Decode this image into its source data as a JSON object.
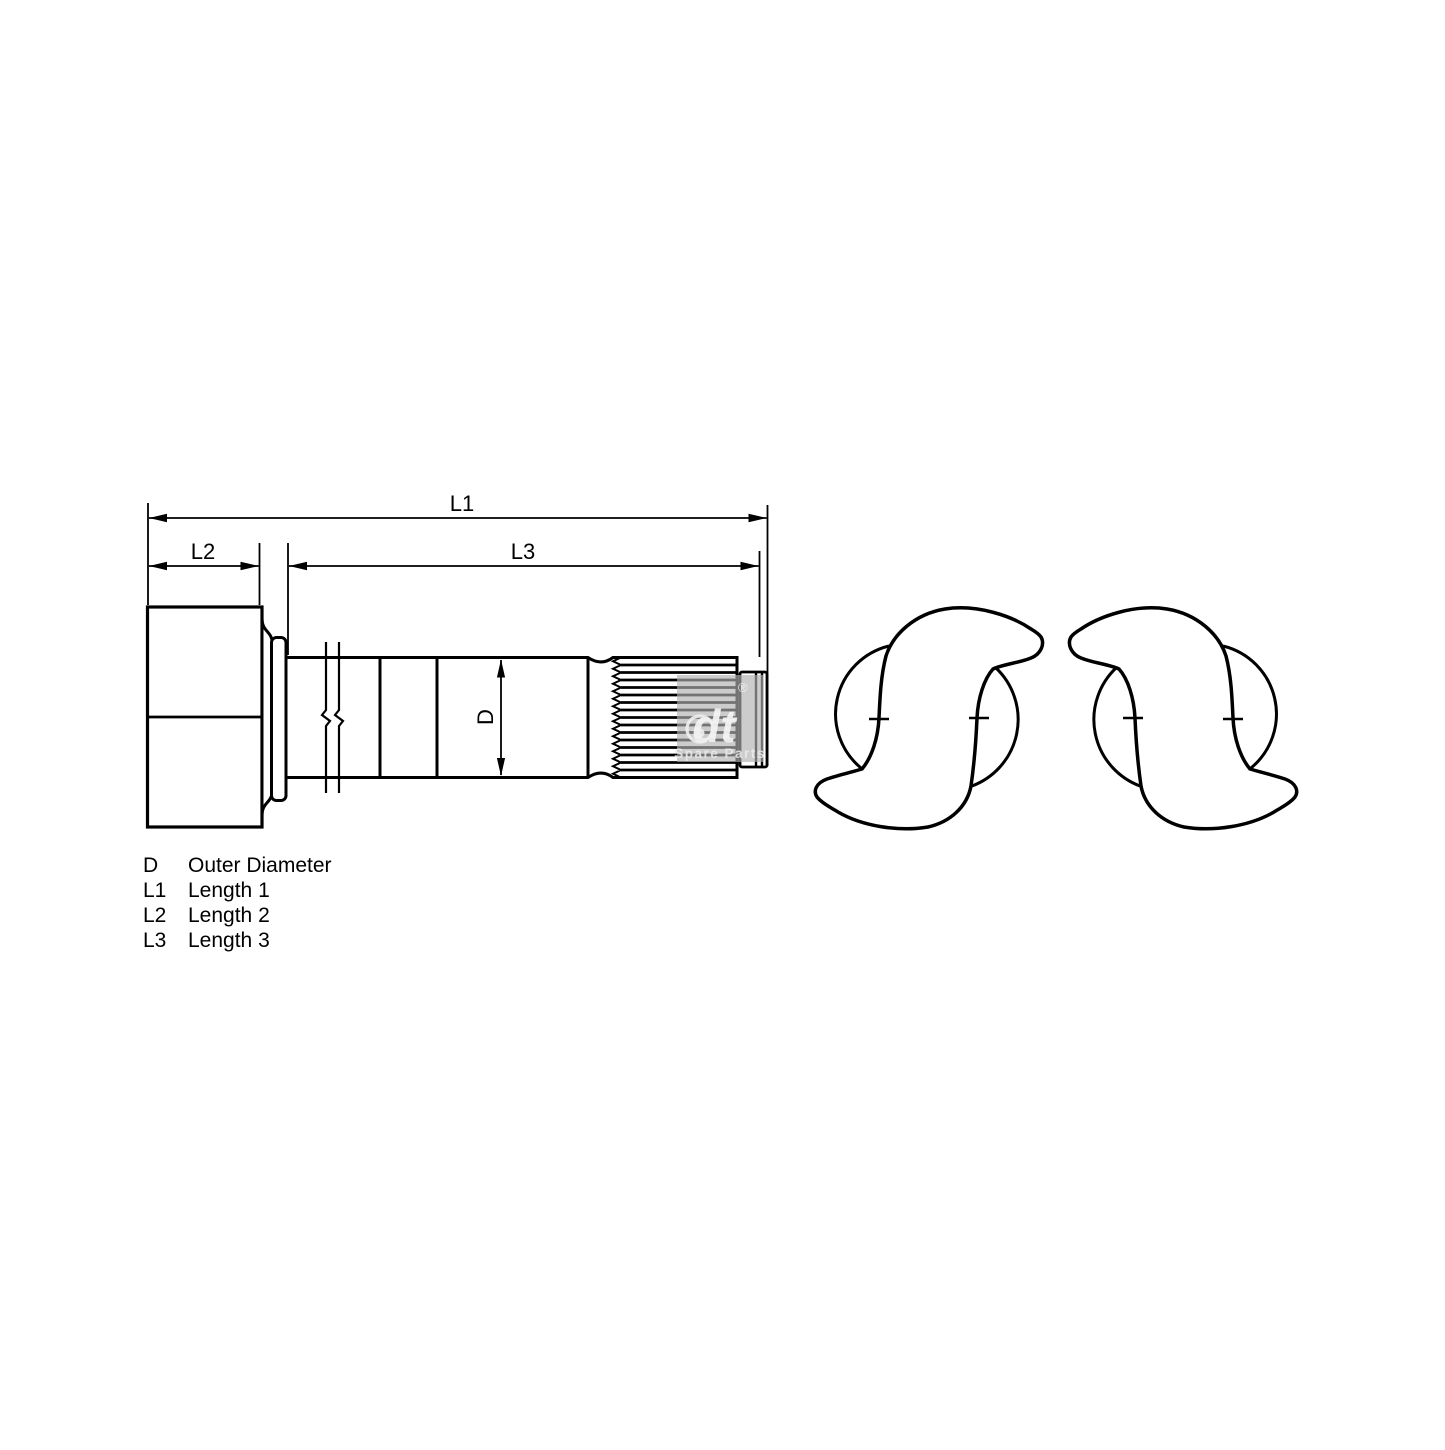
{
  "diagram": {
    "background": "#ffffff",
    "line_color": "#000000",
    "labels": {
      "l1": "L1",
      "l2": "L2",
      "l3": "L3",
      "d": "D"
    },
    "legend": [
      {
        "symbol": "D",
        "description": "Outer Diameter"
      },
      {
        "symbol": "L1",
        "description": "Length 1"
      },
      {
        "symbol": "L2",
        "description": "Length 2"
      },
      {
        "symbol": "L3",
        "description": "Length 3"
      }
    ],
    "watermark": {
      "logo_text": "dt",
      "registered_mark": "®",
      "subtitle": "Spare Parts",
      "color": "#b0b0b0"
    }
  }
}
